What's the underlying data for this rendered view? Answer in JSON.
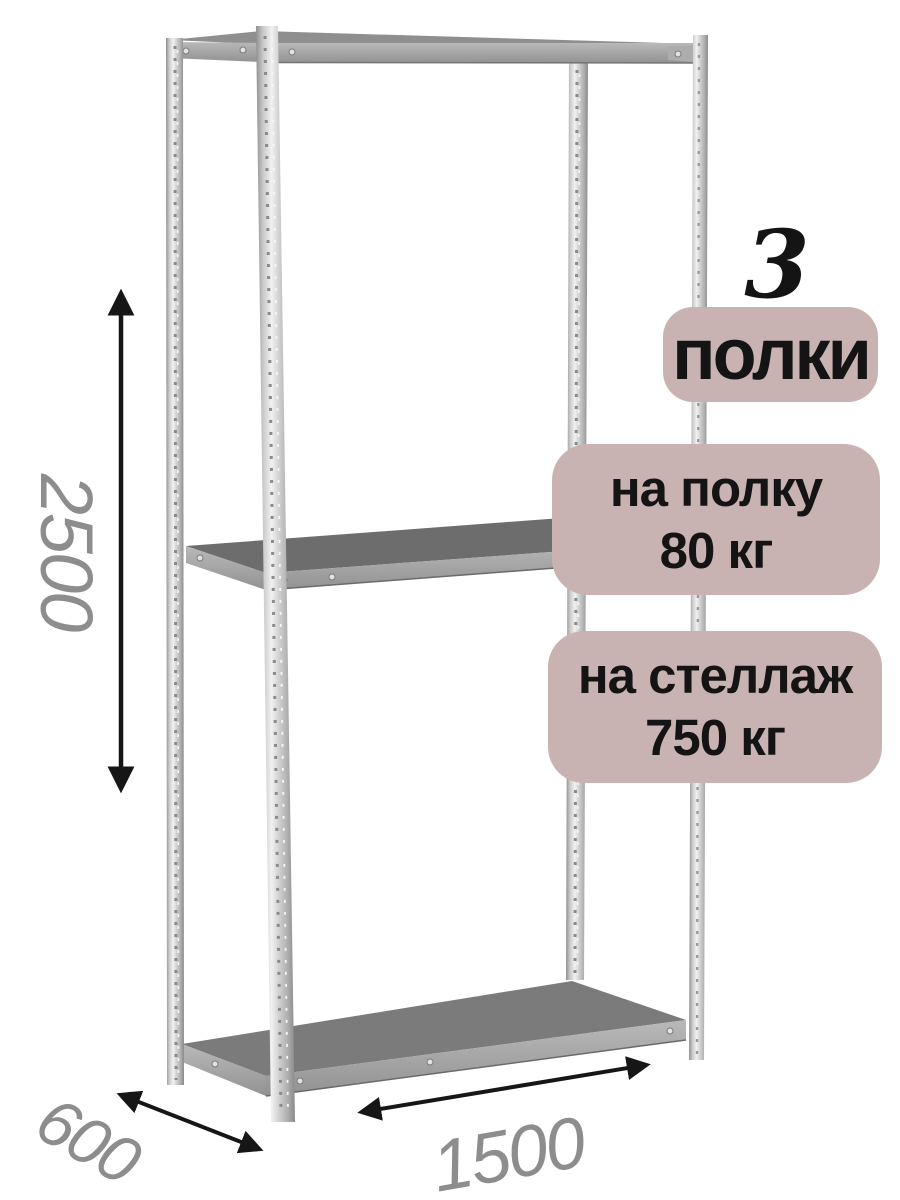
{
  "product": {
    "shelf_count": "3",
    "shelf_count_unit": "полки",
    "per_shelf": {
      "label": "на полку",
      "value": "80 кг"
    },
    "per_rack": {
      "label": "на стеллаж",
      "value": "750 кг"
    }
  },
  "dimensions": {
    "height_mm": "2500",
    "depth_mm": "600",
    "width_mm": "1500"
  },
  "colors": {
    "badge_bg": "#c9b2b2",
    "badge_text": "#141414",
    "dimension_text": "#8d8d8d",
    "arrow": "#161616",
    "metal_light": "#ededed",
    "metal_mid": "#a8a8a8",
    "shelf_surface_dark": "#6d6d6d"
  }
}
